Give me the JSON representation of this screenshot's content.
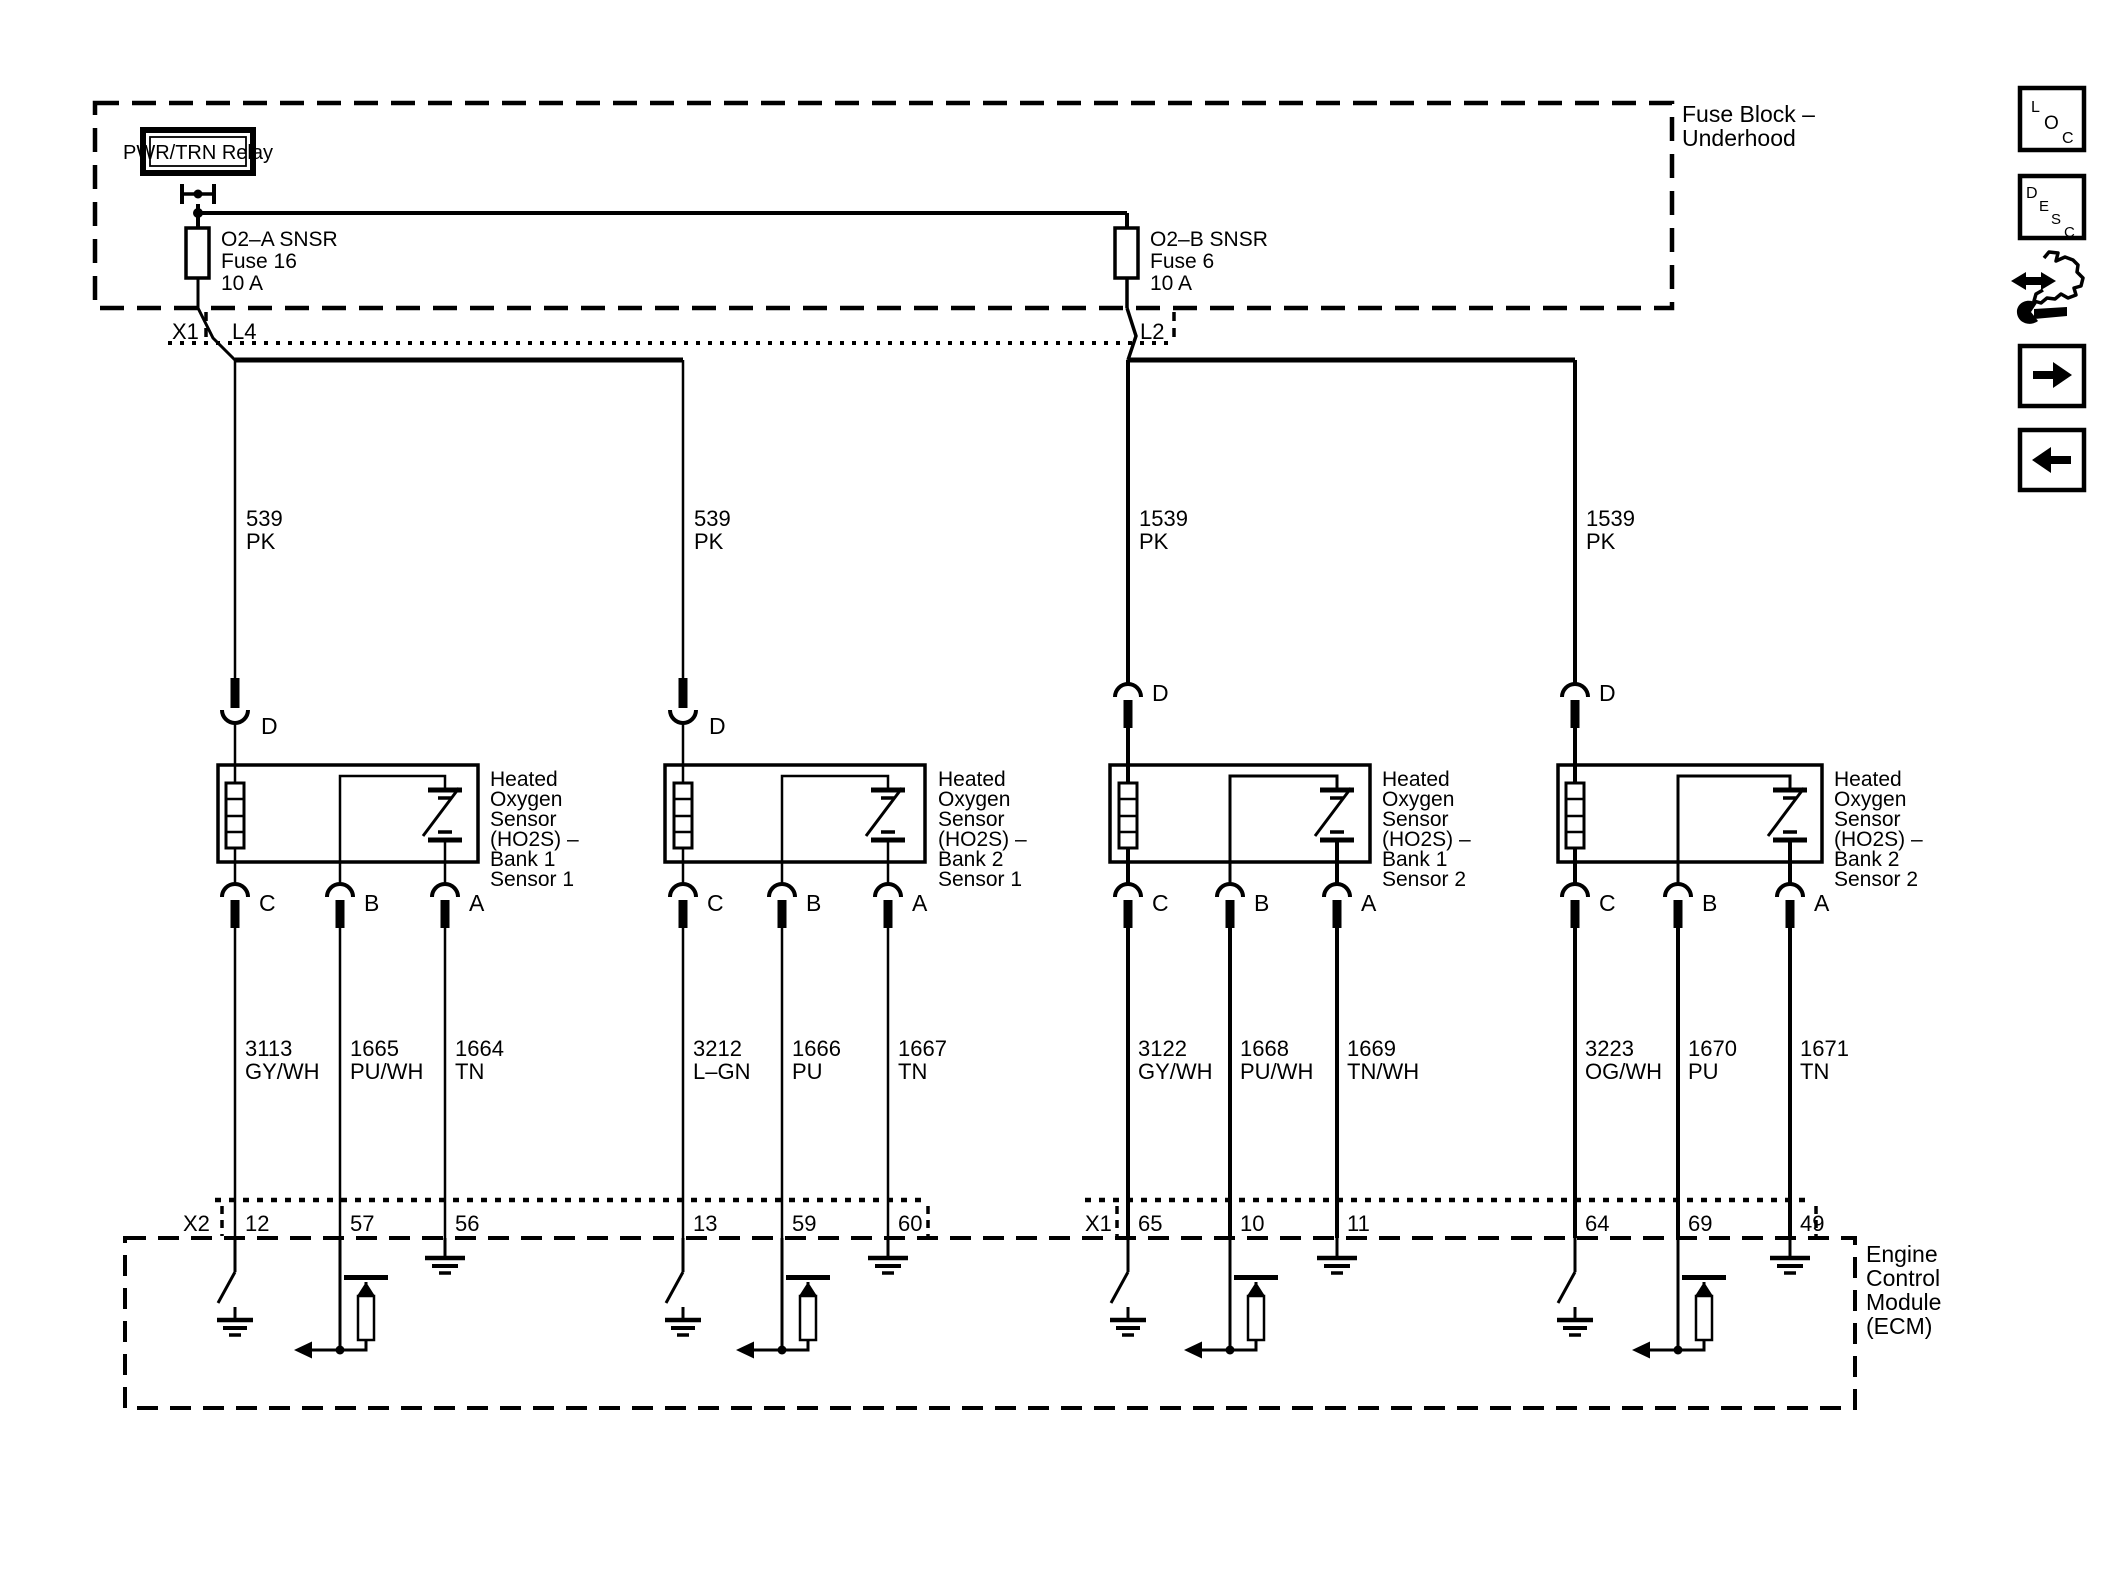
{
  "colors": {
    "ink": "#000000",
    "paper": "#ffffff"
  },
  "fuse_block": {
    "label_lines": [
      "Fuse Block –",
      "Underhood"
    ],
    "relay_label": "PWR/TRN Relay",
    "fuse_a": {
      "name": "O2–A SNSR",
      "id": "Fuse 16",
      "rating": "10 A"
    },
    "fuse_b": {
      "name": "O2–B SNSR",
      "id": "Fuse 6",
      "rating": "10 A"
    },
    "connector_row": {
      "shell": "X1",
      "cavity_left": "L4",
      "cavity_right": "L2"
    }
  },
  "feeds": [
    {
      "circuit": "539",
      "color": "PK"
    },
    {
      "circuit": "539",
      "color": "PK"
    },
    {
      "circuit": "1539",
      "color": "PK"
    },
    {
      "circuit": "1539",
      "color": "PK"
    }
  ],
  "sensors": [
    {
      "name_lines": [
        "Heated",
        "Oxygen",
        "Sensor",
        "(HO2S) –",
        "Bank 1",
        "Sensor 1"
      ],
      "pin_d": "D",
      "pin_c": "C",
      "pin_b": "B",
      "pin_a": "A",
      "wires": [
        {
          "circuit": "3113",
          "color": "GY/WH",
          "ecm_pin": "12"
        },
        {
          "circuit": "1665",
          "color": "PU/WH",
          "ecm_pin": "57"
        },
        {
          "circuit": "1664",
          "color": "TN",
          "ecm_pin": "56"
        }
      ]
    },
    {
      "name_lines": [
        "Heated",
        "Oxygen",
        "Sensor",
        "(HO2S) –",
        "Bank 2",
        "Sensor 1"
      ],
      "pin_d": "D",
      "pin_c": "C",
      "pin_b": "B",
      "pin_a": "A",
      "wires": [
        {
          "circuit": "3212",
          "color": "L–GN",
          "ecm_pin": "13"
        },
        {
          "circuit": "1666",
          "color": "PU",
          "ecm_pin": "59"
        },
        {
          "circuit": "1667",
          "color": "TN",
          "ecm_pin": "60"
        }
      ]
    },
    {
      "name_lines": [
        "Heated",
        "Oxygen",
        "Sensor",
        "(HO2S) –",
        "Bank 1",
        "Sensor 2"
      ],
      "pin_d": "D",
      "pin_c": "C",
      "pin_b": "B",
      "pin_a": "A",
      "wires": [
        {
          "circuit": "3122",
          "color": "GY/WH",
          "ecm_pin": "65"
        },
        {
          "circuit": "1668",
          "color": "PU/WH",
          "ecm_pin": "10"
        },
        {
          "circuit": "1669",
          "color": "TN/WH",
          "ecm_pin": "11"
        }
      ]
    },
    {
      "name_lines": [
        "Heated",
        "Oxygen",
        "Sensor",
        "(HO2S) –",
        "Bank 2",
        "Sensor 2"
      ],
      "pin_d": "D",
      "pin_c": "C",
      "pin_b": "B",
      "pin_a": "A",
      "wires": [
        {
          "circuit": "3223",
          "color": "OG/WH",
          "ecm_pin": "64"
        },
        {
          "circuit": "1670",
          "color": "PU",
          "ecm_pin": "69"
        },
        {
          "circuit": "1671",
          "color": "TN",
          "ecm_pin": "49"
        }
      ]
    }
  ],
  "ecm": {
    "name_lines": [
      "Engine",
      "Control",
      "Module",
      "(ECM)"
    ],
    "connector_left": "X2",
    "connector_right": "X1"
  },
  "nav": {
    "loc_letters": [
      "L",
      "O",
      "C"
    ],
    "desc_letters": [
      "D",
      "E",
      "S",
      "C"
    ]
  }
}
